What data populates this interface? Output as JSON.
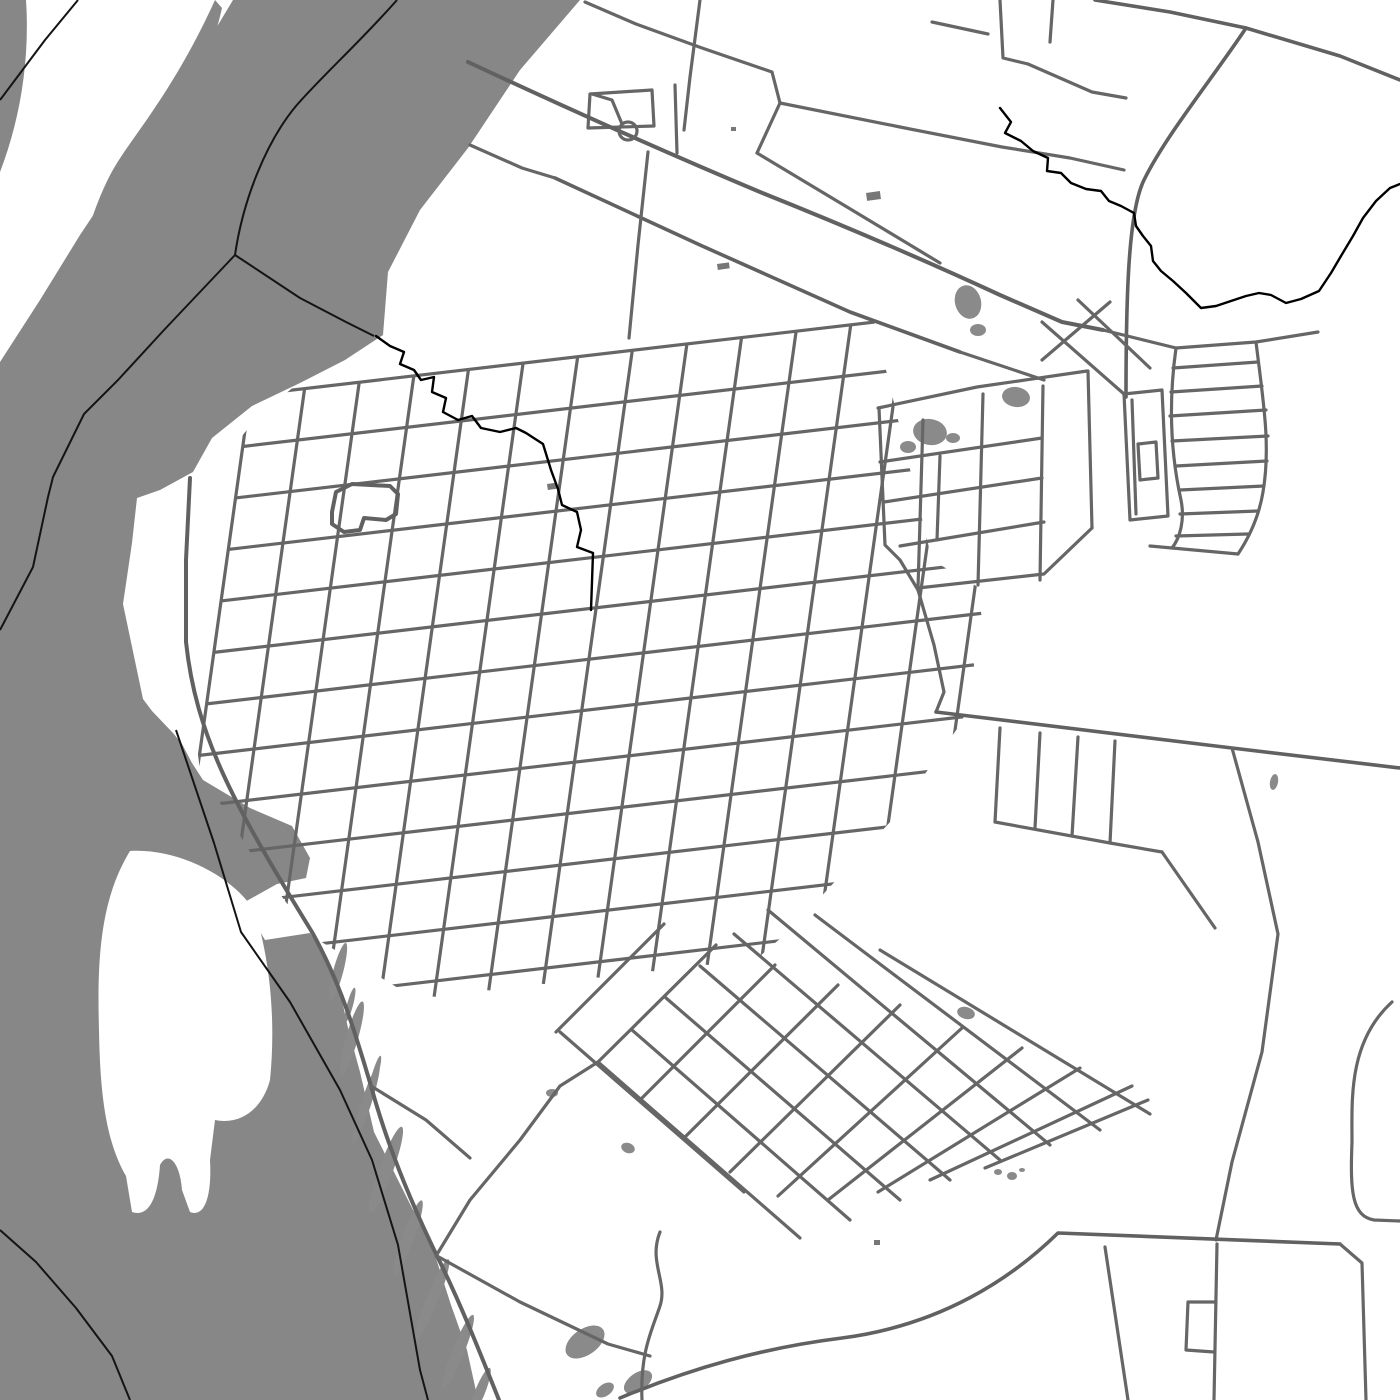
{
  "meta": {
    "title": "Monochrome city street map with river, islands and street grid",
    "map_type": "street-map-poster"
  },
  "map": {
    "width": 1400,
    "height": 1400,
    "colors": {
      "land": "#ffffff",
      "water": "#878787",
      "wetland": "#8a8a8a",
      "road": "#666666",
      "road_major": "#616161",
      "building": "#777777",
      "boundary": "#141414",
      "stream": "#000000"
    },
    "water_polygons": [
      "M 233,0 L 580,0 L 520,70 L 468,148 L 420,210 L 388,272 L 383,335 L 345,360 L 300,383 L 252,406 L 212,438 L 193,472 L 160,490 L 137,498 L 132,543 L 123,604 L 143,699 L 152,711 L 173,733 L 182,744 L 192,763 L 203,780 L 250,808 L 292,826 L 310,858 L 306,878 L 277,884 L 243,903 L 265,940 L 310,933 L 337,977 L 348,1028 L 360,1072 L 374,1132 L 404,1192 L 434,1252 L 451,1305 L 467,1350 L 478,1400 L 0,1400 L 0,362 L 40,300 L 80,235 L 120,175 L 160,120 L 200,55 Z",
      "M 0,0 L 26,0 C 30,60 20,120 0,172 Z",
      "M 215,0 L 222,8 C 210,62 188,102 163,134 C 148,152 138,162 128,177 C 113,197 99,226 90,252 C 86,259 81,252 85,240 C 94,210 104,185 114,168 C 126,148 140,130 152,112 C 174,80 196,42 215,0 Z"
    ],
    "island_polygons": [
      "M 130,851 C 100,900 97,960 99,1030 C 100,1090 105,1140 126,1176 L 132,1212 C 150,1218 158,1195 160,1165 C 168,1150 180,1162 182,1190 L 190,1212 C 205,1218 212,1195 210,1160 L 215,1120 C 240,1125 262,1110 270,1080 C 276,1020 270,960 255,912 C 235,878 180,848 130,851 Z"
    ],
    "wetlands": [
      {
        "cx": 338,
        "cy": 972,
        "rx": 5,
        "ry": 30,
        "rot": 15
      },
      {
        "cx": 352,
        "cy": 1038,
        "rx": 6,
        "ry": 38,
        "rot": 16
      },
      {
        "cx": 366,
        "cy": 1104,
        "rx": 5,
        "ry": 42,
        "rot": 18
      },
      {
        "cx": 386,
        "cy": 1170,
        "rx": 7,
        "ry": 46,
        "rot": 20
      },
      {
        "cx": 408,
        "cy": 1238,
        "rx": 6,
        "ry": 40,
        "rot": 20
      },
      {
        "cx": 432,
        "cy": 1300,
        "rx": 6,
        "ry": 44,
        "rot": 22
      },
      {
        "cx": 458,
        "cy": 1352,
        "rx": 6,
        "ry": 40,
        "rot": 22
      },
      {
        "cx": 480,
        "cy": 1392,
        "rx": 5,
        "ry": 26,
        "rot": 22
      },
      {
        "cx": 350,
        "cy": 1005,
        "rx": 3,
        "ry": 18,
        "rot": 15
      },
      {
        "cx": 375,
        "cy": 1075,
        "rx": 3,
        "ry": 20,
        "rot": 16
      },
      {
        "cx": 585,
        "cy": 1342,
        "rx": 22,
        "ry": 13,
        "rot": -35
      },
      {
        "cx": 638,
        "cy": 1382,
        "rx": 16,
        "ry": 9,
        "rot": -35
      },
      {
        "cx": 605,
        "cy": 1390,
        "rx": 10,
        "ry": 6,
        "rot": -35
      }
    ],
    "woods": [
      {
        "cx": 968,
        "cy": 302,
        "rx": 13,
        "ry": 17,
        "rot": -15
      },
      {
        "cx": 978,
        "cy": 330,
        "rx": 8,
        "ry": 6,
        "rot": 0
      },
      {
        "cx": 1016,
        "cy": 397,
        "rx": 14,
        "ry": 10,
        "rot": 8
      },
      {
        "cx": 930,
        "cy": 432,
        "rx": 17,
        "ry": 13,
        "rot": 10
      },
      {
        "cx": 908,
        "cy": 447,
        "rx": 8,
        "ry": 6,
        "rot": 0
      },
      {
        "cx": 953,
        "cy": 438,
        "rx": 7,
        "ry": 5,
        "rot": 0
      },
      {
        "cx": 552,
        "cy": 1093,
        "rx": 6,
        "ry": 4,
        "rot": 0
      },
      {
        "cx": 628,
        "cy": 1148,
        "rx": 7,
        "ry": 5,
        "rot": 20
      },
      {
        "cx": 966,
        "cy": 1013,
        "rx": 9,
        "ry": 6,
        "rot": 15
      },
      {
        "cx": 1274,
        "cy": 782,
        "rx": 4,
        "ry": 8,
        "rot": 10
      },
      {
        "cx": 998,
        "cy": 1172,
        "rx": 4,
        "ry": 3,
        "rot": 0
      },
      {
        "cx": 1012,
        "cy": 1176,
        "rx": 5,
        "ry": 4,
        "rot": 0
      },
      {
        "cx": 1022,
        "cy": 1170,
        "rx": 3,
        "ry": 2,
        "rot": 0
      }
    ],
    "buildings": [
      {
        "x": 866,
        "y": 193,
        "w": 14,
        "h": 8,
        "rot": -8
      },
      {
        "x": 717,
        "y": 264,
        "w": 12,
        "h": 6,
        "rot": -8
      },
      {
        "x": 731,
        "y": 127,
        "w": 5,
        "h": 4,
        "rot": 0
      },
      {
        "x": 547,
        "y": 484,
        "w": 9,
        "h": 6,
        "rot": -8
      },
      {
        "x": 874,
        "y": 1240,
        "w": 6,
        "h": 5,
        "rot": 0
      }
    ],
    "grids": [
      {
        "origin": [
          250,
          395
        ],
        "u": [
          0.993,
          -0.116
        ],
        "v": [
          -0.139,
          0.99
        ],
        "nu": 15,
        "su": 55,
        "nv": 13,
        "sv": 52,
        "lenU": 780,
        "lenV": 640,
        "clip": "360,330 700,292 872,312 932,560 1000,600 962,722 892,820 790,930 650,1052 520,1076 418,1000 310,935 255,860 200,770 183,640 186,505 255,420"
      }
    ],
    "roads": [
      {
        "d": "M 190,478 L 186,560 L 186,642 C 196,735 232,802 312,932 C 342,986 356,1036 371,1086 C 383,1130 403,1186 437,1256 C 459,1300 479,1350 499,1400",
        "w": 4
      },
      {
        "d": "M 371,1086 L 426,1120 L 470,1158",
        "w": 3.2
      },
      {
        "d": "M 437,1256 L 520,1302 L 608,1344 L 650,1356",
        "w": 3.2
      },
      {
        "d": "M 332,512 L 336,492 L 352,484 L 390,486 L 398,494 L 396,514 L 386,520 L 364,518 L 360,530 L 344,532 L 332,524 Z",
        "w": 4
      },
      {
        "d": "M 622,124 L 612,100 L 592,94",
        "w": 3.2
      },
      {
        "d": "M 588,128 L 590,94 L 652,90 L 654,126 Z",
        "w": 3.2
      },
      {
        "d": "M 468,62 C 560,105 660,150 760,192 C 850,228 920,258 1000,295 L 1062,322 L 1103,330",
        "w": 4
      },
      {
        "d": "M 555,178 L 700,245 L 850,312 L 960,352",
        "w": 3.6
      },
      {
        "d": "M 960,352 L 1044,380",
        "w": 3.2
      },
      {
        "d": "M 585,2 L 636,24 L 702,48 L 772,72 L 780,103",
        "w": 3.2
      },
      {
        "d": "M 780,103 L 900,127 L 1002,147 L 1070,158 L 1124,170",
        "w": 3.2
      },
      {
        "d": "M 757,153 L 852,210 L 940,263",
        "w": 3.2
      },
      {
        "d": "M 780,103 L 757,153",
        "w": 3.2
      },
      {
        "d": "M 648,152 L 638,245 L 629,338",
        "w": 3.2
      },
      {
        "d": "M 700,0 L 690,77 L 684,130",
        "w": 3.2
      },
      {
        "d": "M 675,85 L 677,153",
        "w": 3.2
      },
      {
        "d": "M 470,145 L 522,168 L 555,178",
        "w": 3.2
      },
      {
        "d": "M 1095,0 L 1170,12 L 1246,28 L 1340,56 L 1400,80",
        "w": 3.6
      },
      {
        "d": "M 1246,28 C 1215,75 1166,135 1144,180 C 1128,212 1126,300 1126,397",
        "w": 3.6
      },
      {
        "d": "M 932,22 L 988,34",
        "w": 3.2
      },
      {
        "d": "M 1000,0 L 1003,58 L 1028,64",
        "w": 3.2
      },
      {
        "d": "M 1053,0 L 1050,42",
        "w": 3.2
      },
      {
        "d": "M 1028,64 L 1092,92 L 1126,98",
        "w": 3.2
      },
      {
        "d": "M 878,408 L 977,387 L 1087,371",
        "w": 3.2
      },
      {
        "d": "M 879,408 L 885,545 L 900,560 L 918,590",
        "w": 3.2
      },
      {
        "d": "M 923,420 L 918,588",
        "w": 3.2
      },
      {
        "d": "M 983,394 L 978,585",
        "w": 3.2
      },
      {
        "d": "M 1043,386 L 1040,580",
        "w": 3.2
      },
      {
        "d": "M 1088,371 L 1092,528",
        "w": 3.2
      },
      {
        "d": "M 880,462 L 1042,438",
        "w": 3.2
      },
      {
        "d": "M 884,502 L 1042,478",
        "w": 3.2
      },
      {
        "d": "M 900,546 L 1044,522",
        "w": 3.2
      },
      {
        "d": "M 918,588 L 1044,574 L 1092,528",
        "w": 3.2
      },
      {
        "d": "M 940,456 L 937,540",
        "w": 3.2
      },
      {
        "d": "M 918,590 L 934,645 L 944,692 L 936,712",
        "w": 3.2
      },
      {
        "d": "M 1124,394 L 1162,390 L 1168,516 L 1130,520 Z",
        "w": 3.2
      },
      {
        "d": "M 1132,400 L 1136,514",
        "w": 3.2
      },
      {
        "d": "M 1138,444 L 1156,442 L 1158,478 L 1140,480 Z",
        "w": 3.2
      },
      {
        "d": "M 1176,348 C 1168,405 1171,455 1181,500 C 1185,520 1180,538 1172,548",
        "w": 3.2
      },
      {
        "d": "M 1256,342 C 1263,400 1271,445 1263,492 C 1259,516 1250,536 1238,554",
        "w": 3.2
      },
      {
        "d": "M 1173,368 L 1258,362",
        "w": 3.2
      },
      {
        "d": "M 1171,392 L 1262,386",
        "w": 3.2
      },
      {
        "d": "M 1170,416 L 1266,410",
        "w": 3.2
      },
      {
        "d": "M 1172,441 L 1268,436",
        "w": 3.2
      },
      {
        "d": "M 1176,466 L 1267,461",
        "w": 3.2
      },
      {
        "d": "M 1180,490 L 1264,486",
        "w": 3.2
      },
      {
        "d": "M 1180,514 L 1258,511",
        "w": 3.2
      },
      {
        "d": "M 1176,536 L 1248,534",
        "w": 3.2
      },
      {
        "d": "M 1103,330 L 1176,348 L 1256,342 L 1318,332",
        "w": 3.2
      },
      {
        "d": "M 1150,546 L 1238,554",
        "w": 3.2
      },
      {
        "d": "M 1042,322 L 1124,394",
        "w": 3.2
      },
      {
        "d": "M 1078,300 L 1150,368",
        "w": 3.2
      },
      {
        "d": "M 1042,360 L 1110,302",
        "w": 3.2
      },
      {
        "d": "M 936,712 L 1232,748 L 1400,768",
        "w": 3.6
      },
      {
        "d": "M 1232,748 L 1258,842 L 1278,934 L 1262,1052 L 1232,1162 L 1216,1240",
        "w": 3.2
      },
      {
        "d": "M 1000,728 L 995,822",
        "w": 3.2
      },
      {
        "d": "M 1040,733 L 1035,828",
        "w": 3.2
      },
      {
        "d": "M 1078,737 L 1072,836",
        "w": 3.2
      },
      {
        "d": "M 1115,741 L 1110,843",
        "w": 3.2
      },
      {
        "d": "M 995,822 L 1110,843 L 1162,852",
        "w": 3.2
      },
      {
        "d": "M 1162,852 L 1215,928",
        "w": 3.2
      },
      {
        "d": "M 1392,1002 C 1348,1042 1352,1100 1352,1142 C 1350,1192 1352,1216 1374,1220 L 1400,1221",
        "w": 3.2
      },
      {
        "d": "M 620,1398 C 692,1368 762,1348 842,1338 C 942,1325 1012,1278 1058,1233 L 1340,1244",
        "w": 3.6
      },
      {
        "d": "M 1340,1244 L 1362,1263 L 1366,1400",
        "w": 3.2
      },
      {
        "d": "M 1105,1247 L 1128,1400",
        "w": 3.2
      },
      {
        "d": "M 1217,1244 L 1214,1400",
        "w": 3.2
      },
      {
        "d": "M 1216,1302 L 1188,1302 L 1186,1350 L 1214,1352",
        "w": 3.2
      },
      {
        "d": "M 660,1232 C 648,1262 668,1282 660,1306 C 652,1330 640,1352 642,1400",
        "w": 3.2
      },
      {
        "d": "M 598,1062 L 800,1238",
        "w": 3.2
      },
      {
        "d": "M 632,1030 L 850,1220",
        "w": 3.2
      },
      {
        "d": "M 666,998 L 900,1200",
        "w": 3.2
      },
      {
        "d": "M 700,966 L 950,1180",
        "w": 3.2
      },
      {
        "d": "M 734,934 L 1000,1160",
        "w": 3.2
      },
      {
        "d": "M 768,910 L 1050,1145",
        "w": 3.2
      },
      {
        "d": "M 815,915 L 1100,1130",
        "w": 3.2
      },
      {
        "d": "M 880,950 L 1150,1114",
        "w": 3.2
      },
      {
        "d": "M 598,1062 L 716,945",
        "w": 3.2
      },
      {
        "d": "M 640,1100 L 775,965",
        "w": 3.2
      },
      {
        "d": "M 684,1138 L 838,985",
        "w": 3.2
      },
      {
        "d": "M 730,1172 L 900,1005",
        "w": 3.2
      },
      {
        "d": "M 778,1196 L 962,1028",
        "w": 3.2
      },
      {
        "d": "M 828,1200 L 1022,1048",
        "w": 3.2
      },
      {
        "d": "M 878,1192 L 1080,1068",
        "w": 3.2
      },
      {
        "d": "M 930,1180 L 1132,1086",
        "w": 3.2
      },
      {
        "d": "M 985,1168 L 1148,1100",
        "w": 3.2
      },
      {
        "d": "M 556,1032 L 664,924",
        "w": 3.2
      },
      {
        "d": "M 560,1032 L 744,1192",
        "w": 3.2
      },
      {
        "d": "M 436,1256 L 470,1200 L 520,1140 L 560,1086 L 598,1062",
        "w": 3.2
      }
    ],
    "circles": [
      {
        "cx": 628,
        "cy": 131,
        "r": 9
      }
    ],
    "boundaries": [
      "M 78,0 L 45,40 L 0,100",
      "M 397,0 C 360,42 322,76 296,106 C 266,142 243,200 235,255 L 164,330 L 118,380 L 84,414 L 53,477 L 48,497 L 33,567 L 0,630",
      "M 235,255 L 300,298 L 346,322 L 374,336",
      "M 176,730 L 214,843 L 241,932 L 290,1002 L 340,1090 L 372,1160 L 398,1245 L 420,1370 L 428,1400",
      "M 0,1230 L 36,1262 L 76,1308 L 112,1356 L 130,1400"
    ],
    "streams": [
      "M 376,336 L 390,346 L 404,352 L 400,364 L 414,370 L 421,380 L 434,377 L 432,392 L 446,398 L 443,412 L 458,420 L 472,416 L 481,428 L 500,432 L 516,428 L 526,433 L 543,444 L 551,470 L 558,489 L 562,505 L 577,512 L 581,530 L 577,547 L 593,553 L 591,610",
      "M 1000,108 L 1011,122 L 1005,133 L 1021,141 L 1033,151 L 1048,158 L 1047,171 L 1061,173 L 1071,183 L 1086,189 L 1101,191 L 1109,201 L 1121,206 L 1134,213 L 1136,226 L 1143,236 L 1151,246 L 1153,261 L 1161,271 L 1173,281 L 1186,293 L 1201,308 L 1216,306 L 1231,301 L 1246,296 L 1259,293 L 1271,295 L 1286,303 L 1301,299 L 1319,291 L 1331,273 L 1341,256 L 1353,236 L 1363,218 L 1376,201 L 1390,188 L 1400,184"
    ]
  }
}
